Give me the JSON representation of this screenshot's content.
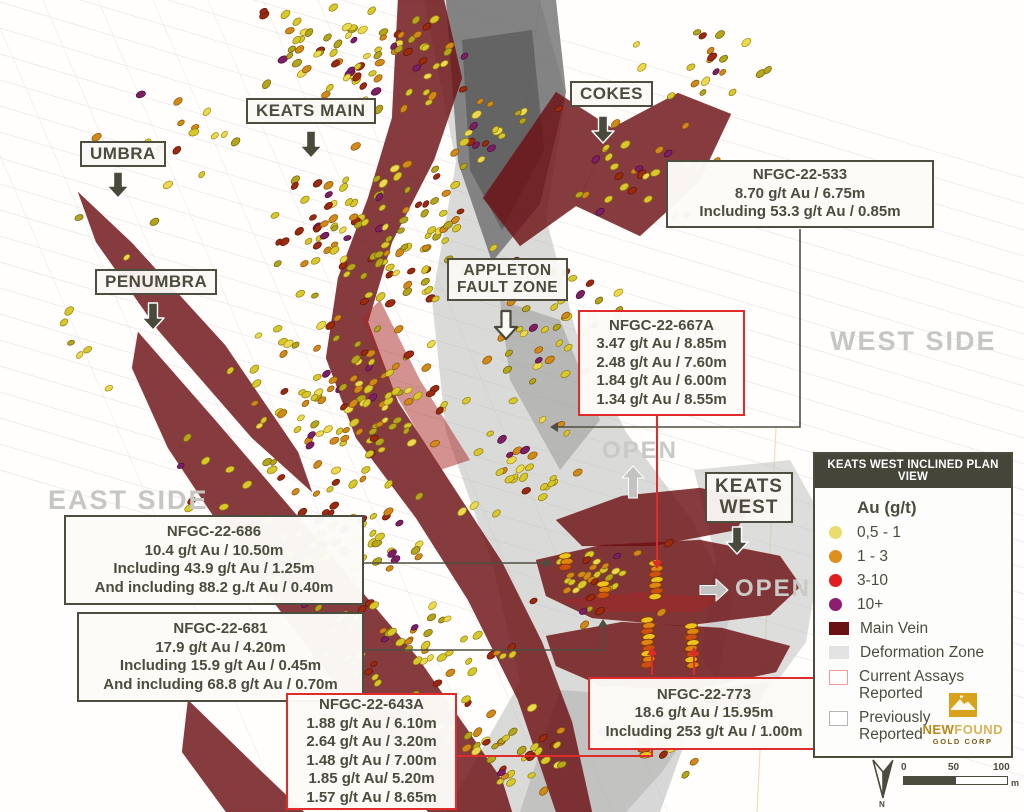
{
  "map_labels": {
    "umbra": "UMBRA",
    "keats_main": "KEATS MAIN",
    "cokes": "COKES",
    "penumbra": "PENUMBRA",
    "appleton_line1": "APPLETON",
    "appleton_line2": "FAULT ZONE",
    "keats_west_line1": "KEATS",
    "keats_west_line2": "WEST",
    "east_side": "EAST SIDE",
    "west_side": "WEST SIDE",
    "open_north": "OPEN",
    "open_east": "OPEN"
  },
  "callouts": {
    "c533": {
      "id": "NFGC-22-533",
      "lines": [
        "8.70 g/t Au / 6.75m",
        "Including 53.3 g/t Au / 0.85m"
      ]
    },
    "c667a": {
      "id": "NFGC-22-667A",
      "lines": [
        "3.47 g/t Au / 8.85m",
        "2.48 g/t Au / 7.60m",
        "1.84 g/t Au / 6.00m",
        "1.34 g/t Au / 8.55m"
      ]
    },
    "c686": {
      "id": "NFGC-22-686",
      "lines": [
        "10.4 g/t Au / 10.50m",
        "Including 43.9 g/t Au / 1.25m",
        "And including 88.2 g./t Au / 0.40m"
      ]
    },
    "c681": {
      "id": "NFGC-22-681",
      "lines": [
        "17.9 g/t Au / 4.20m",
        "Including 15.9 g/t Au / 0.45m",
        "And including 68.8 g/t Au / 0.70m"
      ]
    },
    "c643a": {
      "id": "NFGC-22-643A",
      "lines": [
        "1.88 g/t Au / 6.10m",
        "2.64 g/t Au / 3.20m",
        "1.48 g/t Au / 7.00m",
        "1.85 g/t Au/ 5.20m",
        "1.57 g/t Au / 8.65m"
      ]
    },
    "c773": {
      "id": "NFGC-22-773",
      "lines": [
        "18.6 g/t Au / 15.95m",
        "Including 253 g/t Au / 1.00m"
      ]
    }
  },
  "legend": {
    "title": "KEATS WEST INCLINED PLAN VIEW",
    "au_heading": "Au (g/t)",
    "grades": [
      {
        "label": "0,5 - 1",
        "color": "#eadc6e"
      },
      {
        "label": "1 - 3",
        "color": "#df8f1d"
      },
      {
        "label": "3-10",
        "color": "#e31d1d"
      },
      {
        "label": "10+",
        "color": "#8e1d72"
      }
    ],
    "main_vein_label": "Main Vein",
    "main_vein_color": "#6b1114",
    "deformation_label": "Deformation Zone",
    "deformation_color": "#e3e3e3",
    "current_line1": "Current Assays",
    "current_line2": "Reported",
    "current_border": "#f29a9a",
    "previous_line1": "Previously",
    "previous_line2": "Reported",
    "previous_border": "#b4b4b4",
    "logo_bold": "NEW",
    "logo_light": "FOUND",
    "logo_sub": "GOLD CORP"
  },
  "scalebar": {
    "tick0": "0",
    "tick50": "50",
    "tick100": "100",
    "unit": "m",
    "north": "N"
  },
  "scene": {
    "colors": {
      "vein": "#6b1114",
      "vein_bright": "#a82424",
      "deformation": "#b6b6b6",
      "deformation_dark": "#616161",
      "trace": "#e2e2e2",
      "guide_yellow": "#ead9a0",
      "connector_dark": "#4e4e42",
      "connector_red": "#e02b2b",
      "arrow_dark": "#4a4a3c",
      "arrow_gray": "#c3c3c1",
      "arrow_outline_fill": "#faf9f5"
    },
    "disc_palette": [
      {
        "f": "#d9c829",
        "s": "#8e7d0e",
        "w": 0.3
      },
      {
        "f": "#ecd94e",
        "s": "#a08c12",
        "w": 0.12
      },
      {
        "f": "#b5a51a",
        "s": "#6e600c",
        "w": 0.2
      },
      {
        "f": "#d18a17",
        "s": "#8a5208",
        "w": 0.18
      },
      {
        "f": "#9b2a0e",
        "s": "#5e1404",
        "w": 0.14
      },
      {
        "f": "#7e1f64",
        "s": "#4a0e3a",
        "w": 0.06
      }
    ],
    "stack_palette": [
      "#edc41c",
      "#e0850f",
      "#cf4f12"
    ],
    "clusters": [
      {
        "cx": 370,
        "cy": 60,
        "rx": 120,
        "ry": 65,
        "n": 90
      },
      {
        "cx": 380,
        "cy": 230,
        "rx": 130,
        "ry": 90,
        "n": 120
      },
      {
        "cx": 350,
        "cy": 400,
        "rx": 130,
        "ry": 90,
        "n": 110
      },
      {
        "cx": 330,
        "cy": 540,
        "rx": 110,
        "ry": 80,
        "n": 70
      },
      {
        "cx": 420,
        "cy": 680,
        "rx": 130,
        "ry": 90,
        "n": 80
      },
      {
        "cx": 520,
        "cy": 755,
        "rx": 90,
        "ry": 50,
        "n": 30
      },
      {
        "cx": 560,
        "cy": 330,
        "rx": 90,
        "ry": 90,
        "n": 45
      },
      {
        "cx": 520,
        "cy": 470,
        "rx": 70,
        "ry": 70,
        "n": 30
      },
      {
        "cx": 640,
        "cy": 170,
        "rx": 90,
        "ry": 55,
        "n": 30
      },
      {
        "cx": 500,
        "cy": 140,
        "rx": 60,
        "ry": 50,
        "n": 20
      },
      {
        "cx": 700,
        "cy": 60,
        "rx": 80,
        "ry": 40,
        "n": 20
      },
      {
        "cx": 150,
        "cy": 130,
        "rx": 110,
        "ry": 80,
        "n": 16
      },
      {
        "cx": 100,
        "cy": 310,
        "rx": 70,
        "ry": 100,
        "n": 10
      },
      {
        "cx": 230,
        "cy": 470,
        "rx": 60,
        "ry": 60,
        "n": 12
      },
      {
        "cx": 620,
        "cy": 580,
        "rx": 70,
        "ry": 55,
        "n": 22
      },
      {
        "cx": 585,
        "cy": 580,
        "rx": 40,
        "ry": 28,
        "n": 10
      },
      {
        "cx": 660,
        "cy": 740,
        "rx": 60,
        "ry": 45,
        "n": 18
      }
    ],
    "stacks": [
      {
        "x": 656,
        "y": 563,
        "n": 7
      },
      {
        "x": 648,
        "y": 620,
        "n": 9
      },
      {
        "x": 692,
        "y": 626,
        "n": 8
      },
      {
        "x": 604,
        "y": 584,
        "n": 3
      },
      {
        "x": 566,
        "y": 556,
        "n": 3
      },
      {
        "x": 645,
        "y": 738,
        "n": 4
      }
    ]
  }
}
